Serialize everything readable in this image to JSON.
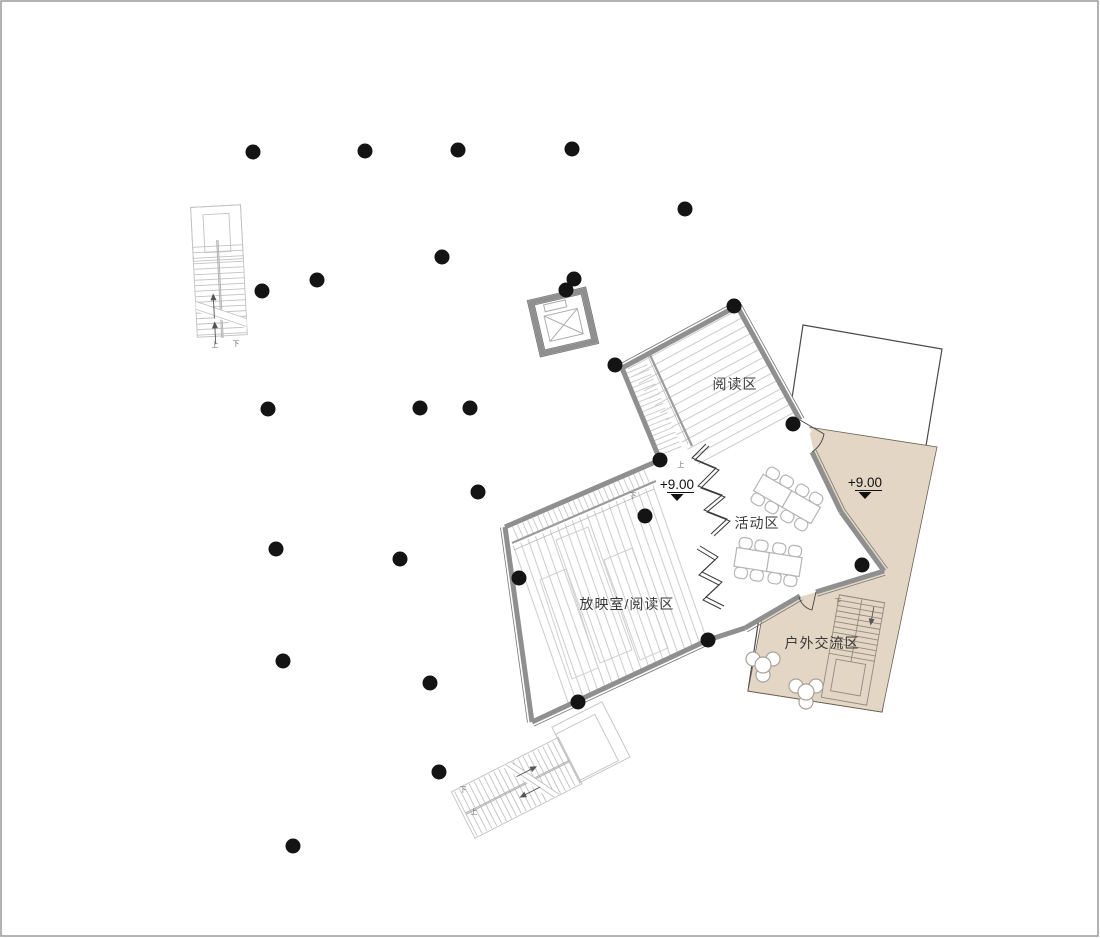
{
  "plan": {
    "type": "architectural-floor-plan",
    "level_elevation": "+9.00",
    "colors": {
      "outdoor_fill": "#e3d6c4",
      "wall": "#8f8f8f",
      "tier_line": "#cccccc",
      "stair_line": "#c2c2c2",
      "column": "#141414",
      "outline": "#4a4a4a",
      "text": "#3a3a3a"
    },
    "room_labels": [
      {
        "id": "reading-area",
        "text": "阅读区",
        "x": 735,
        "y": 389
      },
      {
        "id": "activity-area",
        "text": "活动区",
        "x": 757,
        "y": 528
      },
      {
        "id": "projection-area",
        "text": "放映室/阅读区",
        "x": 627,
        "y": 609
      },
      {
        "id": "outdoor-area",
        "text": "户外交流区",
        "x": 822,
        "y": 648
      }
    ],
    "elevation_markers": [
      {
        "text": "+9.00",
        "x": 677,
        "y": 489
      },
      {
        "text": "+9.00",
        "x": 865,
        "y": 487
      }
    ],
    "stair_labels": [
      {
        "text": "上",
        "x": 215,
        "y": 347
      },
      {
        "text": "下",
        "x": 236,
        "y": 346
      },
      {
        "text": "上",
        "x": 681,
        "y": 467
      },
      {
        "text": "下",
        "x": 633,
        "y": 498
      },
      {
        "text": "下",
        "x": 463,
        "y": 792
      },
      {
        "text": "上",
        "x": 474,
        "y": 814
      },
      {
        "text": "下",
        "x": 838,
        "y": 604
      }
    ],
    "columns": [
      [
        253,
        152
      ],
      [
        365,
        151
      ],
      [
        458,
        150
      ],
      [
        572,
        149
      ],
      [
        685,
        209
      ],
      [
        442,
        257
      ],
      [
        317,
        280
      ],
      [
        262,
        291
      ],
      [
        574,
        279
      ],
      [
        268,
        409
      ],
      [
        420,
        408
      ],
      [
        470,
        408
      ],
      [
        478,
        492
      ],
      [
        276,
        549
      ],
      [
        400,
        559
      ],
      [
        283,
        661
      ],
      [
        430,
        683
      ],
      [
        439,
        772
      ],
      [
        293,
        846
      ],
      [
        566,
        290
      ],
      [
        615,
        365
      ],
      [
        734,
        306
      ],
      [
        793,
        424
      ],
      [
        660,
        460
      ],
      [
        645,
        516
      ],
      [
        519,
        578
      ],
      [
        578,
        702
      ],
      [
        708,
        640
      ],
      [
        862,
        565
      ]
    ]
  }
}
